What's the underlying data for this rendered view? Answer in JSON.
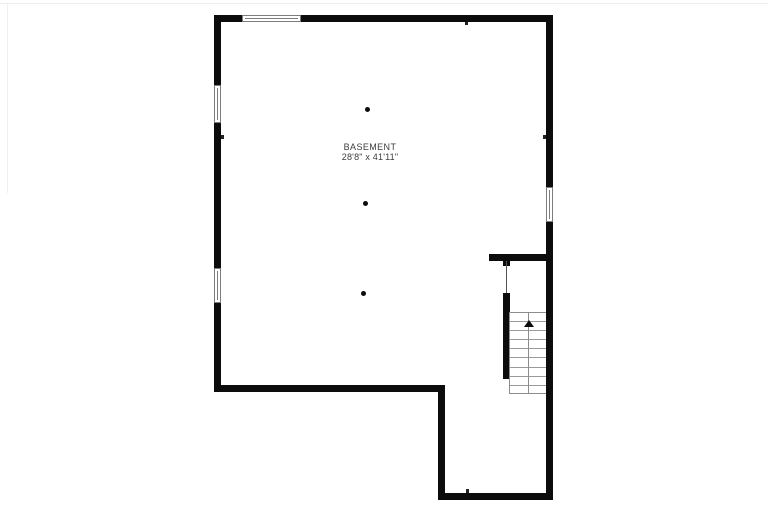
{
  "plan": {
    "room_label": "BASEMENT",
    "room_dimensions": "28'8\" x 41'11\"",
    "stair_direction": "up",
    "stair_step_count": 9,
    "support_column_count": 3,
    "window_count": 4
  },
  "colors": {
    "wall": "#0c0c0c",
    "background": "#ffffff",
    "stair_line": "#9a9a9a",
    "window_outline": "#7d7d7d",
    "label_text": "#3c3c3c"
  }
}
